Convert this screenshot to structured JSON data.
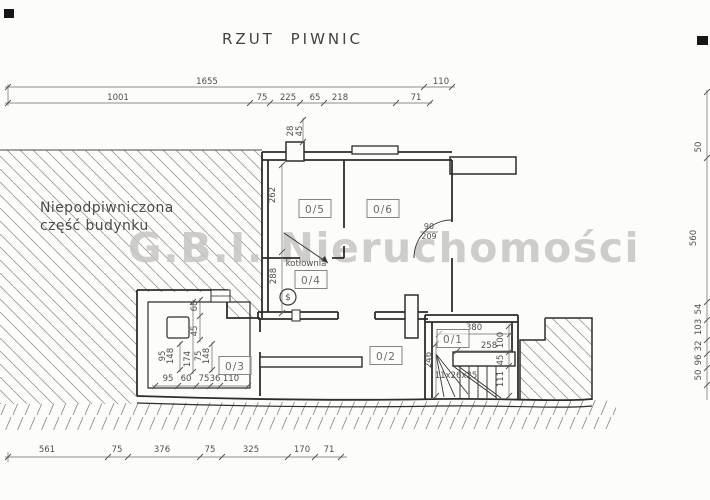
{
  "title": "RZUT PIWNIC",
  "watermark": "G.B.I. Nieruchomości",
  "area_note": {
    "line1": "Niepodpiwniczona",
    "line2": "część budynku"
  },
  "colors": {
    "paper": "#fcfcfb",
    "wall": "#2f2d2a",
    "dim": "#6b6965",
    "hatch": "#a09d98",
    "watermark": "#c7c5c2"
  },
  "rooms": [
    {
      "id": "0/5",
      "x": 315,
      "y": 209
    },
    {
      "id": "0/6",
      "x": 383,
      "y": 209
    },
    {
      "id": "0/4",
      "x": 311,
      "y": 280
    },
    {
      "id": "0/3",
      "x": 235,
      "y": 366
    },
    {
      "id": "0/2",
      "x": 386,
      "y": 356
    },
    {
      "id": "0/1",
      "x": 453,
      "y": 339
    }
  ],
  "texts": [
    {
      "text": "kotłownia",
      "x": 306,
      "y": 266,
      "size": 8.5
    },
    {
      "text": "90",
      "x": 429,
      "y": 229,
      "size": 8
    },
    {
      "text": "209",
      "x": 429,
      "y": 239,
      "size": 8
    },
    {
      "text": "11x26x25",
      "x": 456,
      "y": 378,
      "size": 8.5
    },
    {
      "text": "$",
      "x": 288,
      "y": 300,
      "size": 9
    }
  ],
  "dims": [
    {
      "text": "1655",
      "x": 207,
      "y": 84,
      "rot": 0
    },
    {
      "text": "110",
      "x": 441,
      "y": 84,
      "rot": 0
    },
    {
      "text": "1001",
      "x": 118,
      "y": 100,
      "rot": 0
    },
    {
      "text": "75",
      "x": 262,
      "y": 100,
      "rot": 0
    },
    {
      "text": "225",
      "x": 288,
      "y": 100,
      "rot": 0
    },
    {
      "text": "65",
      "x": 315,
      "y": 100,
      "rot": 0
    },
    {
      "text": "218",
      "x": 340,
      "y": 100,
      "rot": 0
    },
    {
      "text": "71",
      "x": 416,
      "y": 100,
      "rot": 0
    },
    {
      "text": "28",
      "x": 293,
      "y": 131,
      "rot": 1
    },
    {
      "text": "45",
      "x": 302,
      "y": 131,
      "rot": 1
    },
    {
      "text": "262",
      "x": 275,
      "y": 195,
      "rot": 1
    },
    {
      "text": "288",
      "x": 276,
      "y": 276,
      "rot": 1
    },
    {
      "text": "68",
      "x": 197,
      "y": 306,
      "rot": 1
    },
    {
      "text": "45",
      "x": 197,
      "y": 331,
      "rot": 1
    },
    {
      "text": "95",
      "x": 165,
      "y": 356,
      "rot": 1
    },
    {
      "text": "148",
      "x": 173,
      "y": 356,
      "rot": 1
    },
    {
      "text": "174",
      "x": 190,
      "y": 359,
      "rot": 1
    },
    {
      "text": "75",
      "x": 201,
      "y": 356,
      "rot": 1
    },
    {
      "text": "148",
      "x": 209,
      "y": 356,
      "rot": 1
    },
    {
      "text": "95",
      "x": 168,
      "y": 381,
      "rot": 0
    },
    {
      "text": "60",
      "x": 186,
      "y": 381,
      "rot": 0
    },
    {
      "text": "75",
      "x": 204,
      "y": 381,
      "rot": 0
    },
    {
      "text": "36",
      "x": 215,
      "y": 381,
      "rot": 0
    },
    {
      "text": "110",
      "x": 231,
      "y": 381,
      "rot": 0
    },
    {
      "text": "380",
      "x": 474,
      "y": 330,
      "rot": 0
    },
    {
      "text": "258",
      "x": 489,
      "y": 348,
      "rot": 0
    },
    {
      "text": "100",
      "x": 503,
      "y": 340,
      "rot": 1
    },
    {
      "text": "45",
      "x": 503,
      "y": 360,
      "rot": 1
    },
    {
      "text": "111",
      "x": 503,
      "y": 379,
      "rot": 1
    },
    {
      "text": "246",
      "x": 431,
      "y": 360,
      "rot": 1
    },
    {
      "text": "50",
      "x": 701,
      "y": 147,
      "rot": 1
    },
    {
      "text": "560",
      "x": 696,
      "y": 238,
      "rot": 1
    },
    {
      "text": "54",
      "x": 701,
      "y": 309,
      "rot": 1
    },
    {
      "text": "103",
      "x": 701,
      "y": 327,
      "rot": 1
    },
    {
      "text": "32",
      "x": 701,
      "y": 346,
      "rot": 1
    },
    {
      "text": "96",
      "x": 701,
      "y": 360,
      "rot": 1
    },
    {
      "text": "50",
      "x": 701,
      "y": 375,
      "rot": 1
    },
    {
      "text": "561",
      "x": 47,
      "y": 452,
      "rot": 0
    },
    {
      "text": "75",
      "x": 117,
      "y": 452,
      "rot": 0
    },
    {
      "text": "376",
      "x": 162,
      "y": 452,
      "rot": 0
    },
    {
      "text": "75",
      "x": 210,
      "y": 452,
      "rot": 0
    },
    {
      "text": "325",
      "x": 251,
      "y": 452,
      "rot": 0
    },
    {
      "text": "170",
      "x": 302,
      "y": 452,
      "rot": 0
    },
    {
      "text": "71",
      "x": 329,
      "y": 452,
      "rot": 0
    }
  ]
}
